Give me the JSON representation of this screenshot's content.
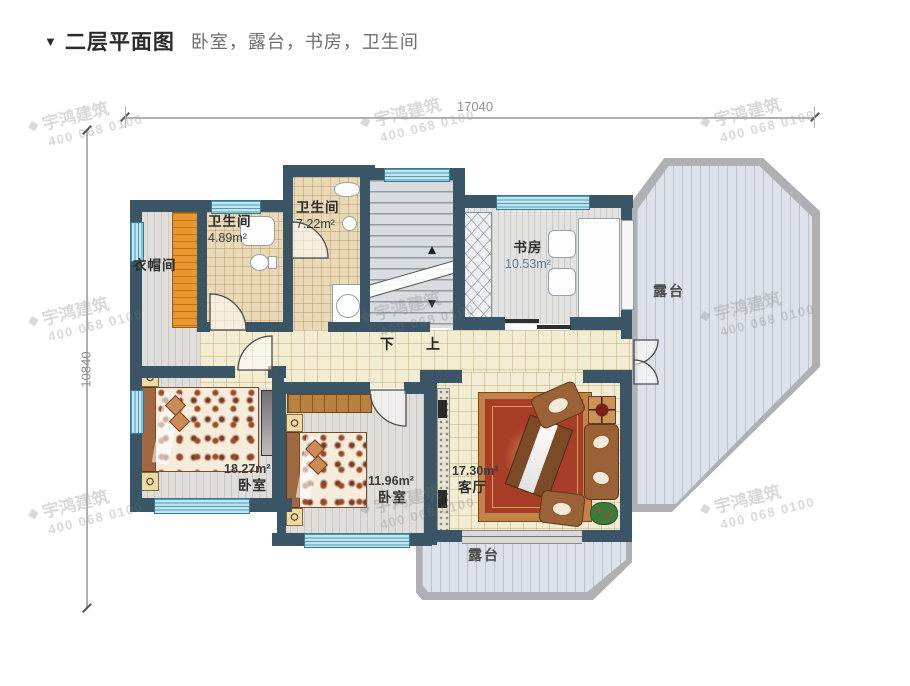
{
  "header": {
    "marker": "▼",
    "title": "二层平面图",
    "subtitle": "卧室，露台，书房，卫生间"
  },
  "dimensions": {
    "width_mm": "17040",
    "height_mm": "10840"
  },
  "watermark": {
    "logo": "◆",
    "brand": "宇鸿建筑",
    "phone": "400 068 0100"
  },
  "stairs": {
    "down": "下",
    "up": "上"
  },
  "rooms": {
    "cloakroom": {
      "label": "衣帽间"
    },
    "bathroom_small": {
      "label": "卫生间",
      "area": "4.89m²"
    },
    "bathroom_large": {
      "label": "卫生间",
      "area": "7.22m²"
    },
    "study": {
      "label": "书房",
      "area": "10.53m²"
    },
    "bedroom_left": {
      "label": "卧室",
      "area": "18.27m²"
    },
    "bedroom_middle": {
      "label": "卧室",
      "area": "11.96m²"
    },
    "living": {
      "label": "客厅",
      "area": "17.30m²"
    },
    "terrace_right": {
      "label": "露台"
    },
    "terrace_bottom": {
      "label": "露台"
    }
  }
}
